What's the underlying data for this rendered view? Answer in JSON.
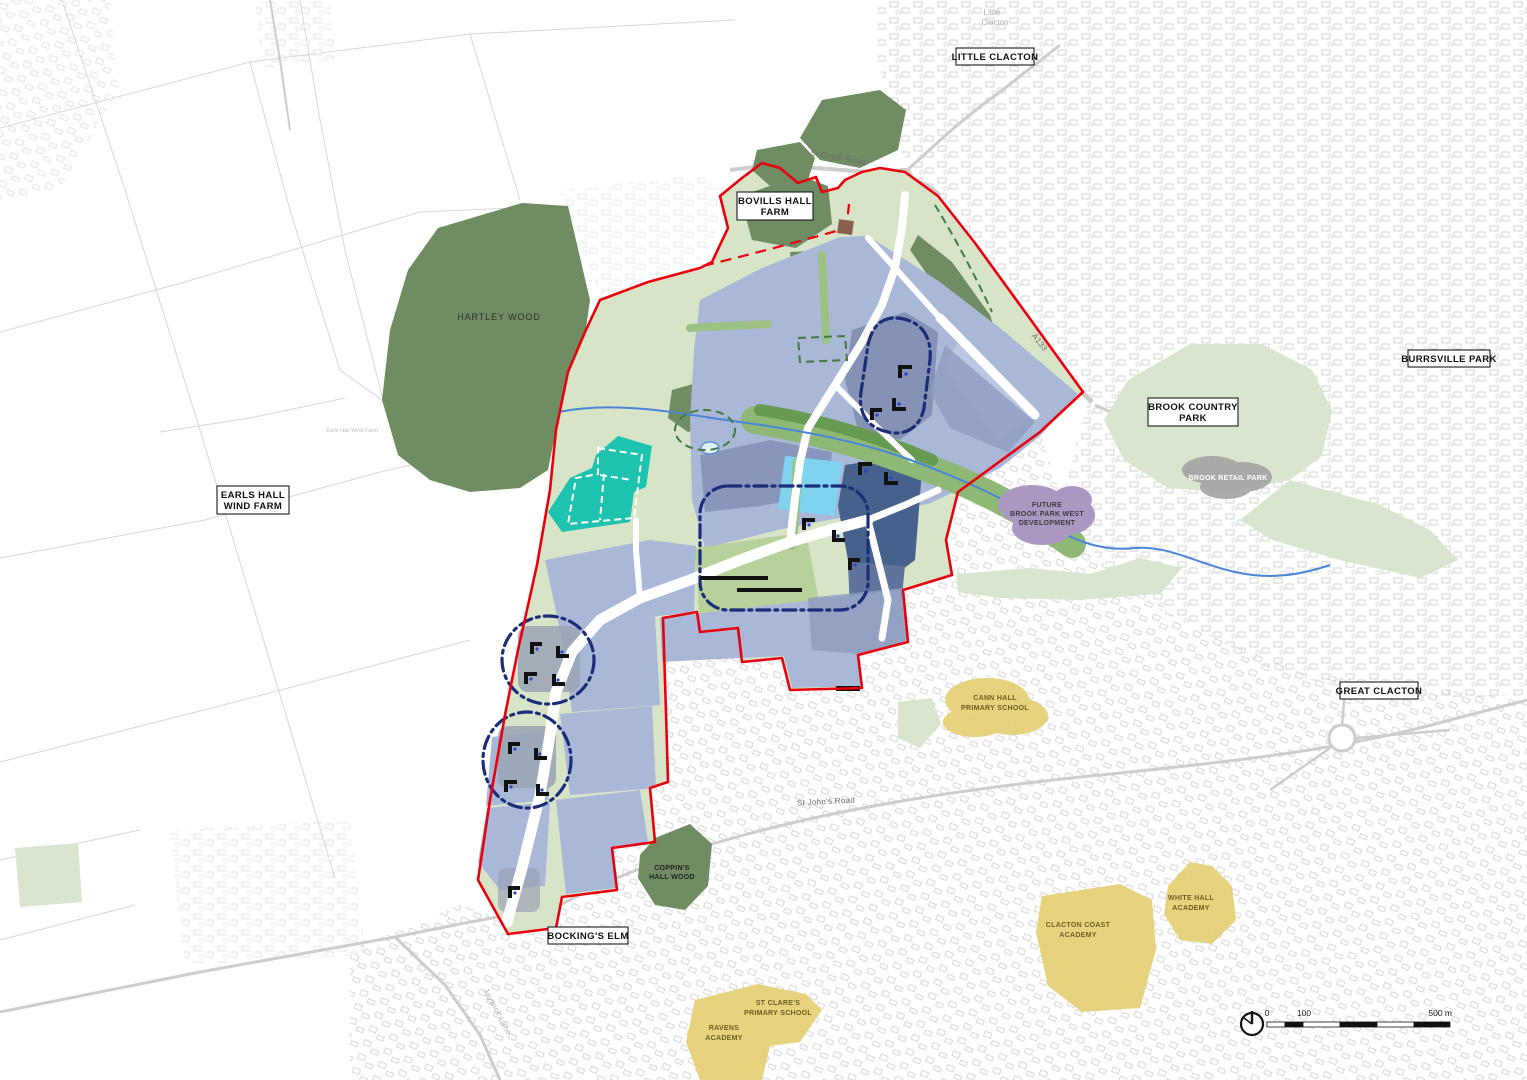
{
  "map": {
    "labels": {
      "little_clacton_box": "LITTLE CLACTON",
      "little_faint_1": "Little",
      "little_faint_2": "Clacton",
      "bovills_1": "BOVILLS HALL",
      "bovills_2": "FARM",
      "earls_1": "EARLS HALL",
      "earls_2": "WIND FARM",
      "earls_faint": "Earls Hall Wind Farm",
      "hartley_wood": "HARTLEY WOOD",
      "brook_country_1": "BROOK COUNTRY",
      "brook_country_2": "PARK",
      "burrsville_park": "BURRSVILLE PARK",
      "brook_retail_park": "BROOK RETAIL PARK",
      "future_1": "FUTURE",
      "future_2": "BROOK PARK WEST",
      "future_3": "DEVELOPMENT",
      "great_clacton": "GREAT CLACTON",
      "cann_1": "CANN HALL",
      "cann_2": "PRIMARY SCHOOL",
      "coppins_1": "COPPIN'S",
      "coppins_2": "HALL WOOD",
      "bockings_elm": "BOCKING'S ELM",
      "st_clares_1": "ST CLARE'S",
      "st_clares_2": "PRIMARY SCHOOL",
      "ravens_1": "RAVENS",
      "ravens_2": "ACADEMY",
      "clacton_coast_1": "CLACTON COAST",
      "clacton_coast_2": "ACADEMY",
      "white_hall_1": "WHITE HALL",
      "white_hall_2": "ACADEMY",
      "st_osyth_road": "St Osyth Road",
      "a133": "A133",
      "st_johns_road": "St John's Road",
      "jaywick_lane": "Jaywick Lane"
    },
    "scalebar": {
      "zero": "0",
      "hundred": "100",
      "five_hundred": "500 m"
    },
    "colors": {
      "boundary_red": "#e8000e",
      "woodland_green": "#6f8c63",
      "open_space_green": "#d7e4c8",
      "parkland_green": "#d9e6cf",
      "corridor_green": "#8fb877",
      "parcel_light_blue": "#a9b8d7",
      "parcel_mid_blue": "#8796ba",
      "parcel_dark_blue": "#46618c",
      "community_cyan": "#7fd2f0",
      "proposed_teal": "#1dc3ae",
      "centre_route_navy": "#1b2d78",
      "stream_blue": "#4a86d8",
      "school_yellow": "#e6d077",
      "future_dev_purple": "#ab98c2",
      "retail_gray": "#a5a5a5"
    }
  }
}
